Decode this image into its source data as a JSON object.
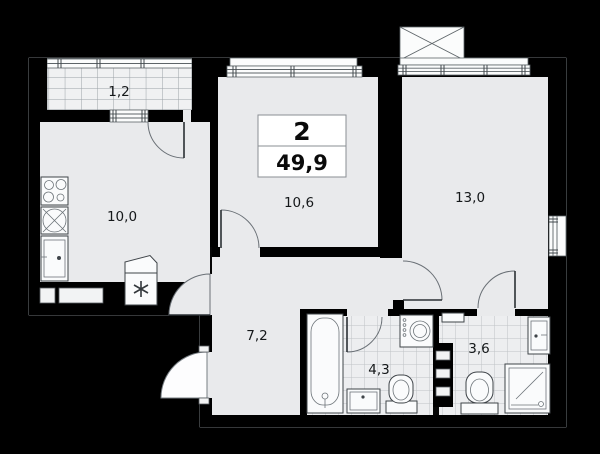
{
  "plan": {
    "title": "apartment-floor-plan",
    "info_box": {
      "room_count": "2",
      "total_area": "49,9"
    },
    "rooms": {
      "balcony": {
        "area": "1,2"
      },
      "kitchen": {
        "area": "10,0"
      },
      "living_room": {
        "area": "10,6"
      },
      "bedroom": {
        "area": "13,0"
      },
      "hallway": {
        "area": "7,2"
      },
      "bathroom": {
        "area": "4,3"
      },
      "shower_room": {
        "area": "3,6"
      }
    },
    "fixtures": [
      "stove-icon",
      "dishwasher-icon",
      "kitchen-sink-icon",
      "fridge-icon",
      "bathtub-icon",
      "washing-machine-icon",
      "vanity-sink-icon",
      "toilet-icon",
      "toilet-icon",
      "shower-cabin-icon",
      "sink-icon",
      "duct-shaft-icon",
      "ac-basket-icon",
      "entrance-door-icon"
    ],
    "colors": {
      "background": "#000000",
      "wall": "#000000",
      "room_fill": "#e9eaec",
      "balcony_fill": "#f0f1f2",
      "bath_fill": "#edeef0",
      "outline": "#8e979c",
      "tile_line": "#bfc3c6",
      "label_text": "#15181a"
    }
  }
}
